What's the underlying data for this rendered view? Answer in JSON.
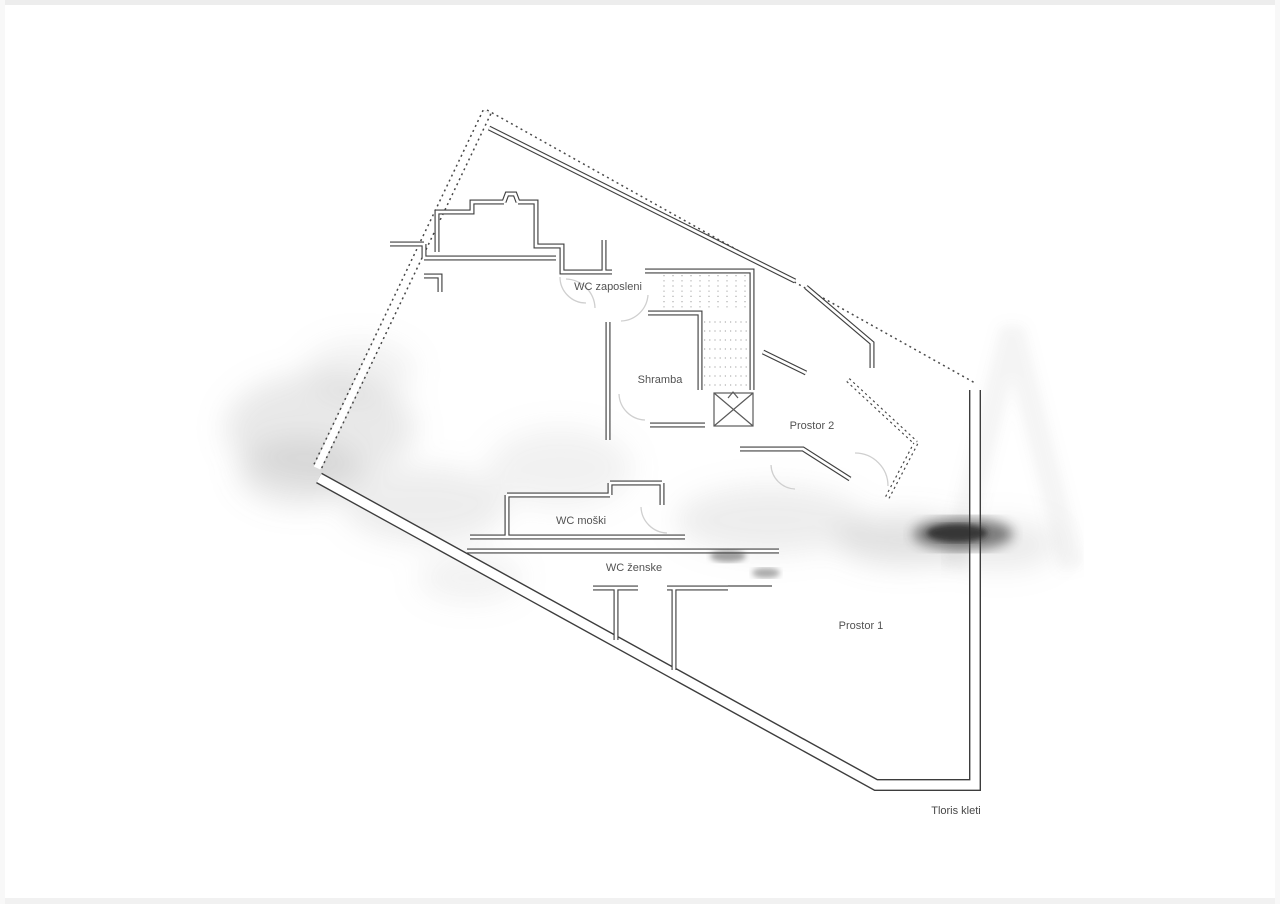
{
  "plan": {
    "caption": "Tloris kleti",
    "rooms": [
      {
        "id": "wc-zaposleni",
        "label": "WC zaposleni"
      },
      {
        "id": "shramba",
        "label": "Shramba"
      },
      {
        "id": "prostor-2",
        "label": "Prostor 2"
      },
      {
        "id": "wc-moski",
        "label": "WC moški"
      },
      {
        "id": "wc-zenske",
        "label": "WC ženske"
      },
      {
        "id": "prostor-1",
        "label": "Prostor 1"
      }
    ],
    "colors": {
      "background": "#ffffff",
      "wall": "#3d3d3d",
      "dashed_boundary": "#464646",
      "door_arc": "#cfcfcf",
      "stair_dots": "#9c9c9c",
      "label_text": "#3a3a3a",
      "smudge_dark": "#2e2e2e"
    }
  }
}
